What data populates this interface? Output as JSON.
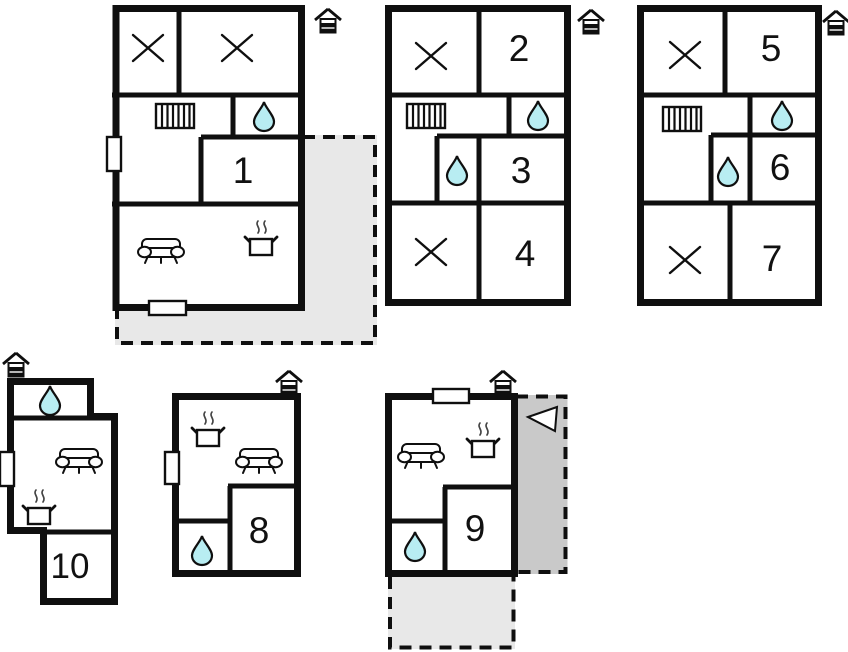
{
  "diagram": {
    "type": "floor-plan",
    "room_labels": {
      "r1": "1",
      "r2": "2",
      "r3": "3",
      "r4": "4",
      "r5": "5",
      "r6": "6",
      "r7": "7",
      "r8": "8",
      "r9": "9",
      "r10": "10"
    }
  },
  "colors": {
    "wall": "#0f0f0f",
    "water_drop_fill": "#b8edf2",
    "terrace_light": "#e8e8e8",
    "terrace_dark": "#c9c9c9",
    "background": "#ffffff",
    "label_text": "#111111"
  },
  "icons": {
    "north": "north-house-icon",
    "bed": "bed-cross-icon",
    "bath": "water-drop-icon",
    "radiator": "radiator-icon",
    "sofa": "sofa-icon",
    "stove": "stove-icon",
    "window": "window-icon",
    "door": "door-icon",
    "terrace_arrow": "terrace-arrow-icon"
  }
}
